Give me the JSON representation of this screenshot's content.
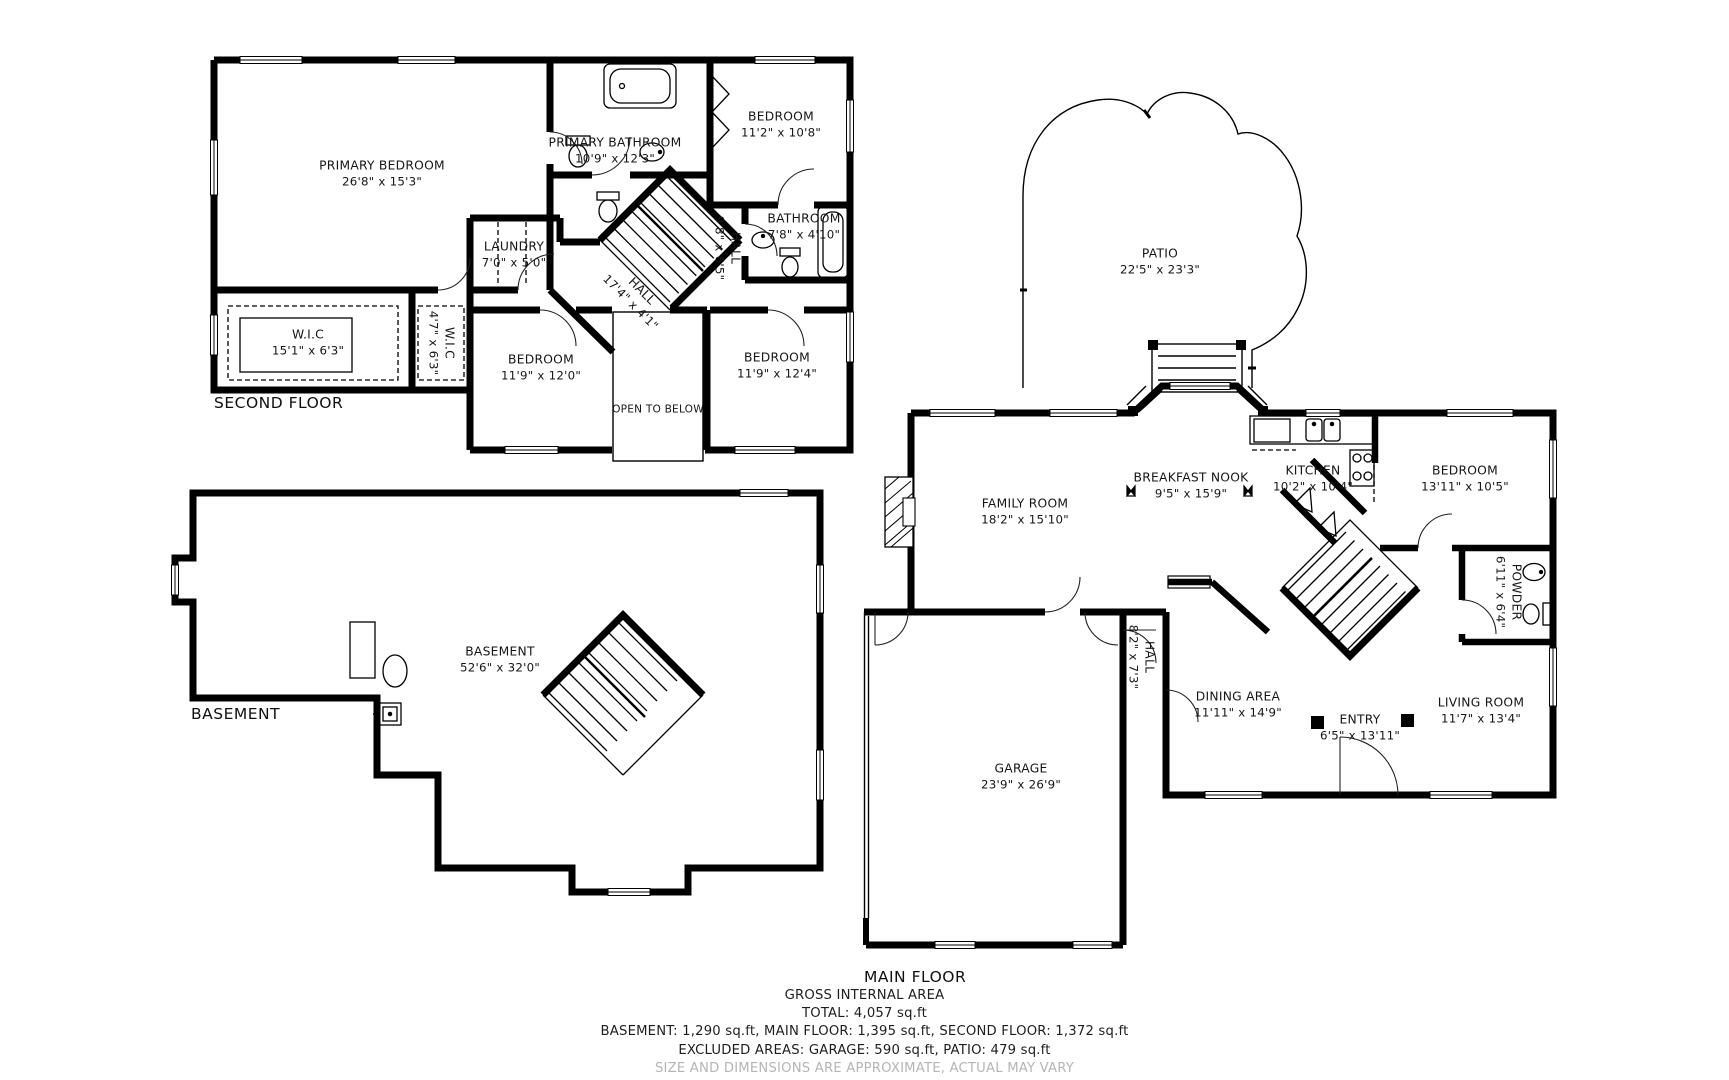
{
  "floors": [
    {
      "label": "SECOND FLOOR",
      "rooms": [
        {
          "name": "PRIMARY BEDROOM",
          "dims": "26'8\" x 15'3\""
        },
        {
          "name": "PRIMARY BATHROOM",
          "dims": "10'9\" x 12'3\""
        },
        {
          "name": "BEDROOM",
          "dims": "11'2\" x 10'8\""
        },
        {
          "name": "W.I.C",
          "dims": "15'1\" x 6'3\""
        },
        {
          "name": "W.I.C",
          "dims": "4'7\" x 6'3\""
        },
        {
          "name": "LAUNDRY",
          "dims": "7'0\" x 5'0\""
        },
        {
          "name": "HALL",
          "dims": "17'4\" x 4'1\""
        },
        {
          "name": "HALL",
          "dims": "9'8\" x 6'5\""
        },
        {
          "name": "BATHROOM",
          "dims": "7'8\" x 4'10\""
        },
        {
          "name": "BEDROOM",
          "dims": "11'9\" x 12'0\""
        },
        {
          "name": "BEDROOM",
          "dims": "11'9\" x 12'4\""
        },
        {
          "name": "OPEN TO BELOW",
          "dims": ""
        }
      ]
    },
    {
      "label": "BASEMENT",
      "rooms": [
        {
          "name": "BASEMENT",
          "dims": "52'6\" x 32'0\""
        }
      ]
    },
    {
      "label": "MAIN FLOOR",
      "rooms": [
        {
          "name": "PATIO",
          "dims": "22'5\" x 23'3\""
        },
        {
          "name": "FAMILY ROOM",
          "dims": "18'2\" x 15'10\""
        },
        {
          "name": "BREAKFAST NOOK",
          "dims": "9'5\" x 15'9\""
        },
        {
          "name": "KITCHEN",
          "dims": "10'2\" x 10'4\""
        },
        {
          "name": "BEDROOM",
          "dims": "13'11\" x 10'5\""
        },
        {
          "name": "POWDER",
          "dims": "6'11\" x 6'4\""
        },
        {
          "name": "HALL",
          "dims": "8'2\" x 7'3\""
        },
        {
          "name": "DINING AREA",
          "dims": "11'11\" x 14'9\""
        },
        {
          "name": "ENTRY",
          "dims": "6'5\" x 13'11\""
        },
        {
          "name": "LIVING ROOM",
          "dims": "11'7\" x 13'4\""
        },
        {
          "name": "GARAGE",
          "dims": "23'9\" x 26'9\""
        }
      ]
    }
  ],
  "footer": {
    "title": "GROSS INTERNAL AREA",
    "total": "TOTAL: 4,057 sq.ft",
    "breakdown": "BASEMENT: 1,290 sq.ft, MAIN FLOOR: 1,395 sq.ft, SECOND FLOOR: 1,372 sq.ft",
    "excluded": "EXCLUDED AREAS: GARAGE: 590 sq.ft, PATIO: 479 sq.ft",
    "disclaimer": "SIZE AND DIMENSIONS ARE APPROXIMATE, ACTUAL MAY VARY"
  },
  "colors": {
    "wall": "#000000",
    "line": "#3a3a3a",
    "text": "#161616",
    "muted": "#b5b5b5",
    "bg": "#ffffff"
  }
}
